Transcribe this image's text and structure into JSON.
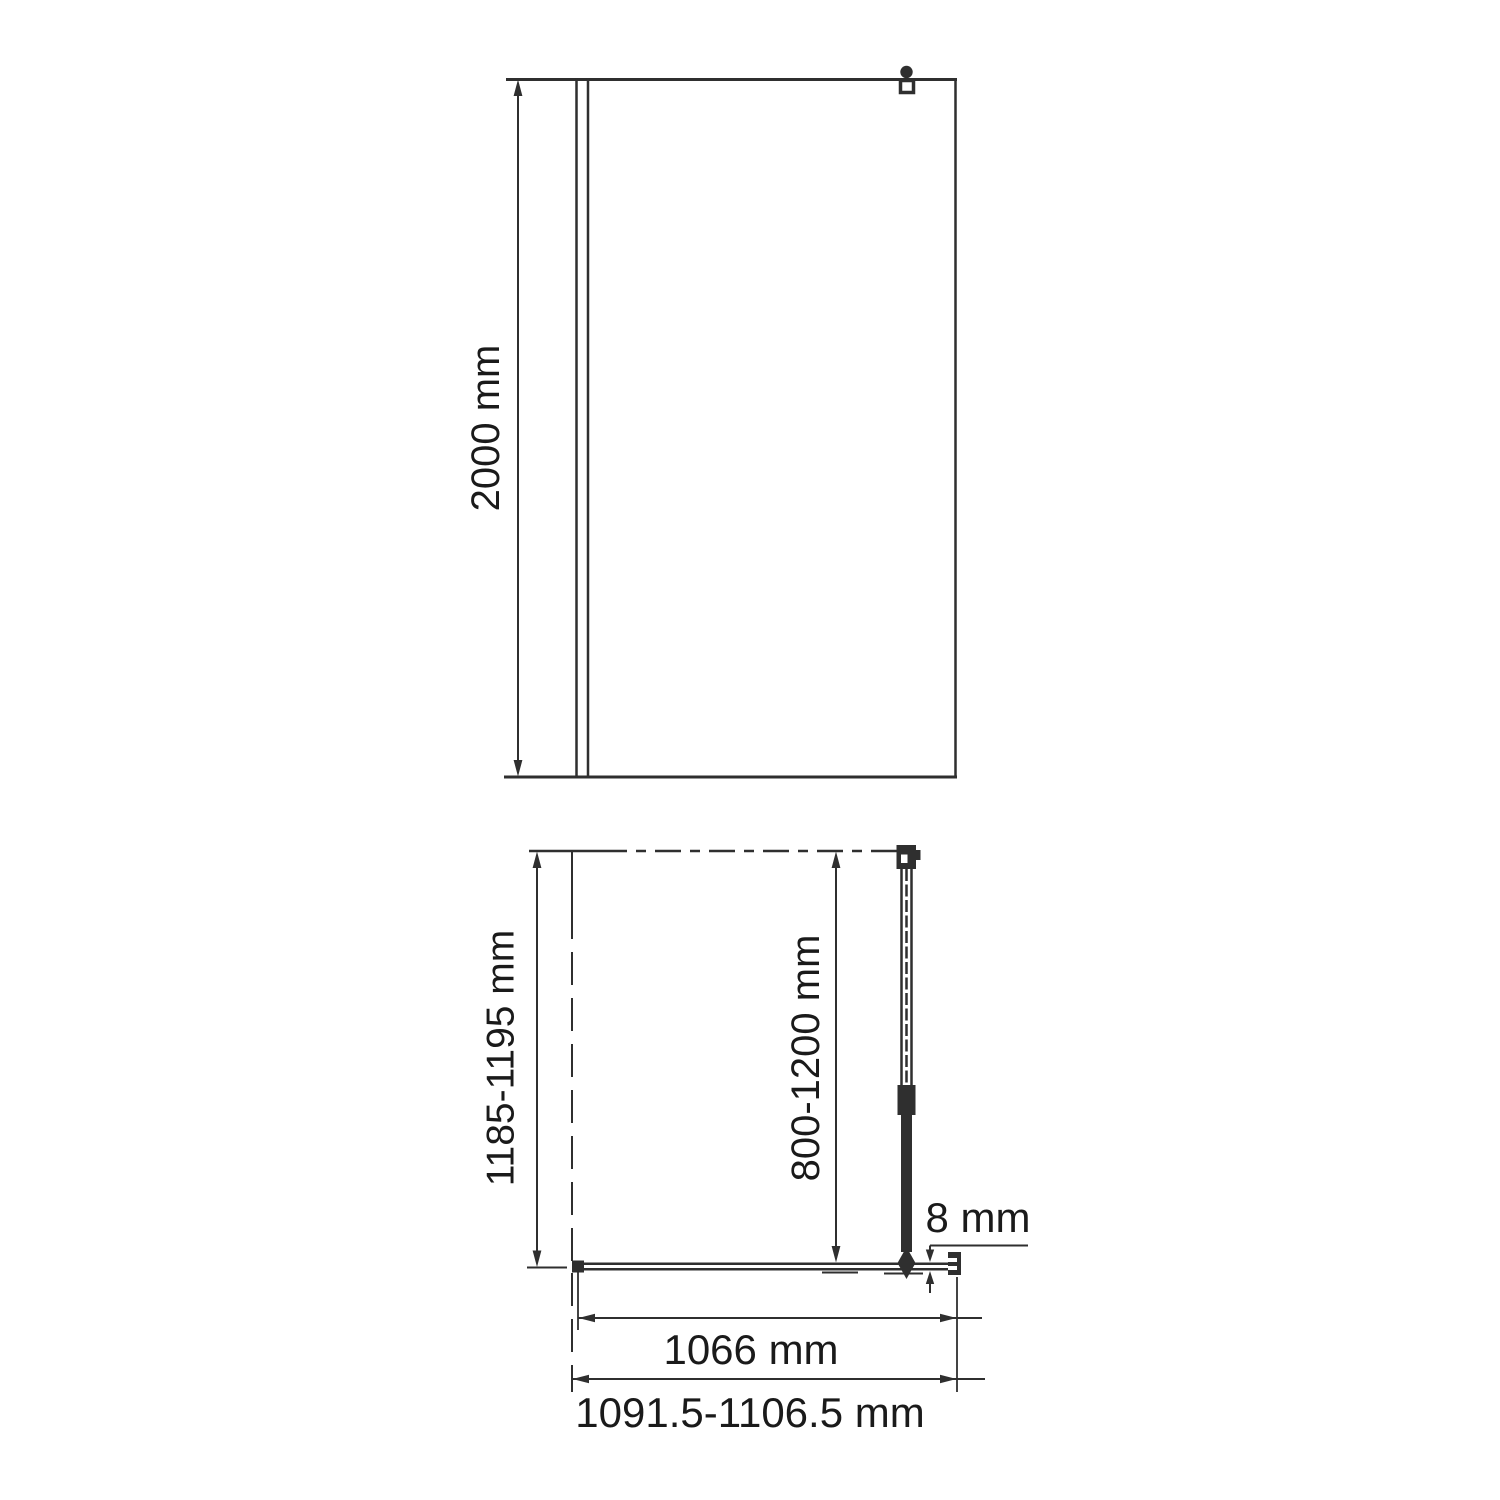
{
  "drawing": {
    "type": "technical-dimension-diagram",
    "subject": "walk-in shower glass screen with support bar",
    "front_view": {
      "height_label": "2000 mm"
    },
    "plan_view": {
      "depth_label": "1185-1195 mm",
      "support_bar_length_label": "800-1200 mm",
      "glass_thickness_label": "8 mm",
      "glass_width_label": "1066 mm",
      "overall_width_label": "1091.5-1106.5 mm"
    }
  },
  "colors": {
    "line": "#2f2f2f",
    "text": "#1a1a1a",
    "background": "#ffffff"
  }
}
